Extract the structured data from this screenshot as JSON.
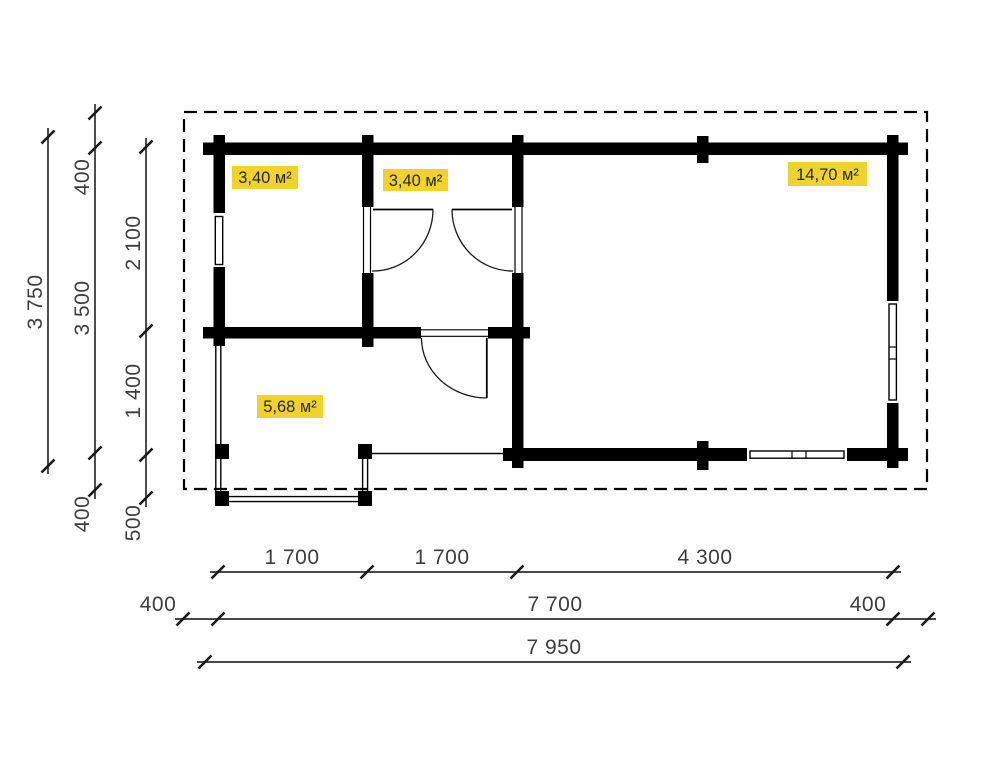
{
  "drawing": {
    "rooms": [
      {
        "id": "room-left-small",
        "area_label": "3,40 м²"
      },
      {
        "id": "room-mid-small",
        "area_label": "3,40 м²"
      },
      {
        "id": "room-large",
        "area_label": "14,70 м²"
      },
      {
        "id": "room-porch",
        "area_label": "5,68 м²"
      }
    ],
    "dims_left": {
      "overall": "3 750",
      "eave_top": "400",
      "wall_span": "3 500",
      "room_depth": "2 100",
      "hall_depth": "1 400",
      "porch_depth": "500",
      "eave_bottom": "400"
    },
    "dims_bottom": {
      "bay1": "1 700",
      "bay2": "1 700",
      "bay3": "4 300",
      "eave_left": "400",
      "wall_span": "7 700",
      "eave_right": "400",
      "overall": "7 950"
    },
    "colors": {
      "highlight": "#f0d22d",
      "wall": "#000000"
    }
  }
}
